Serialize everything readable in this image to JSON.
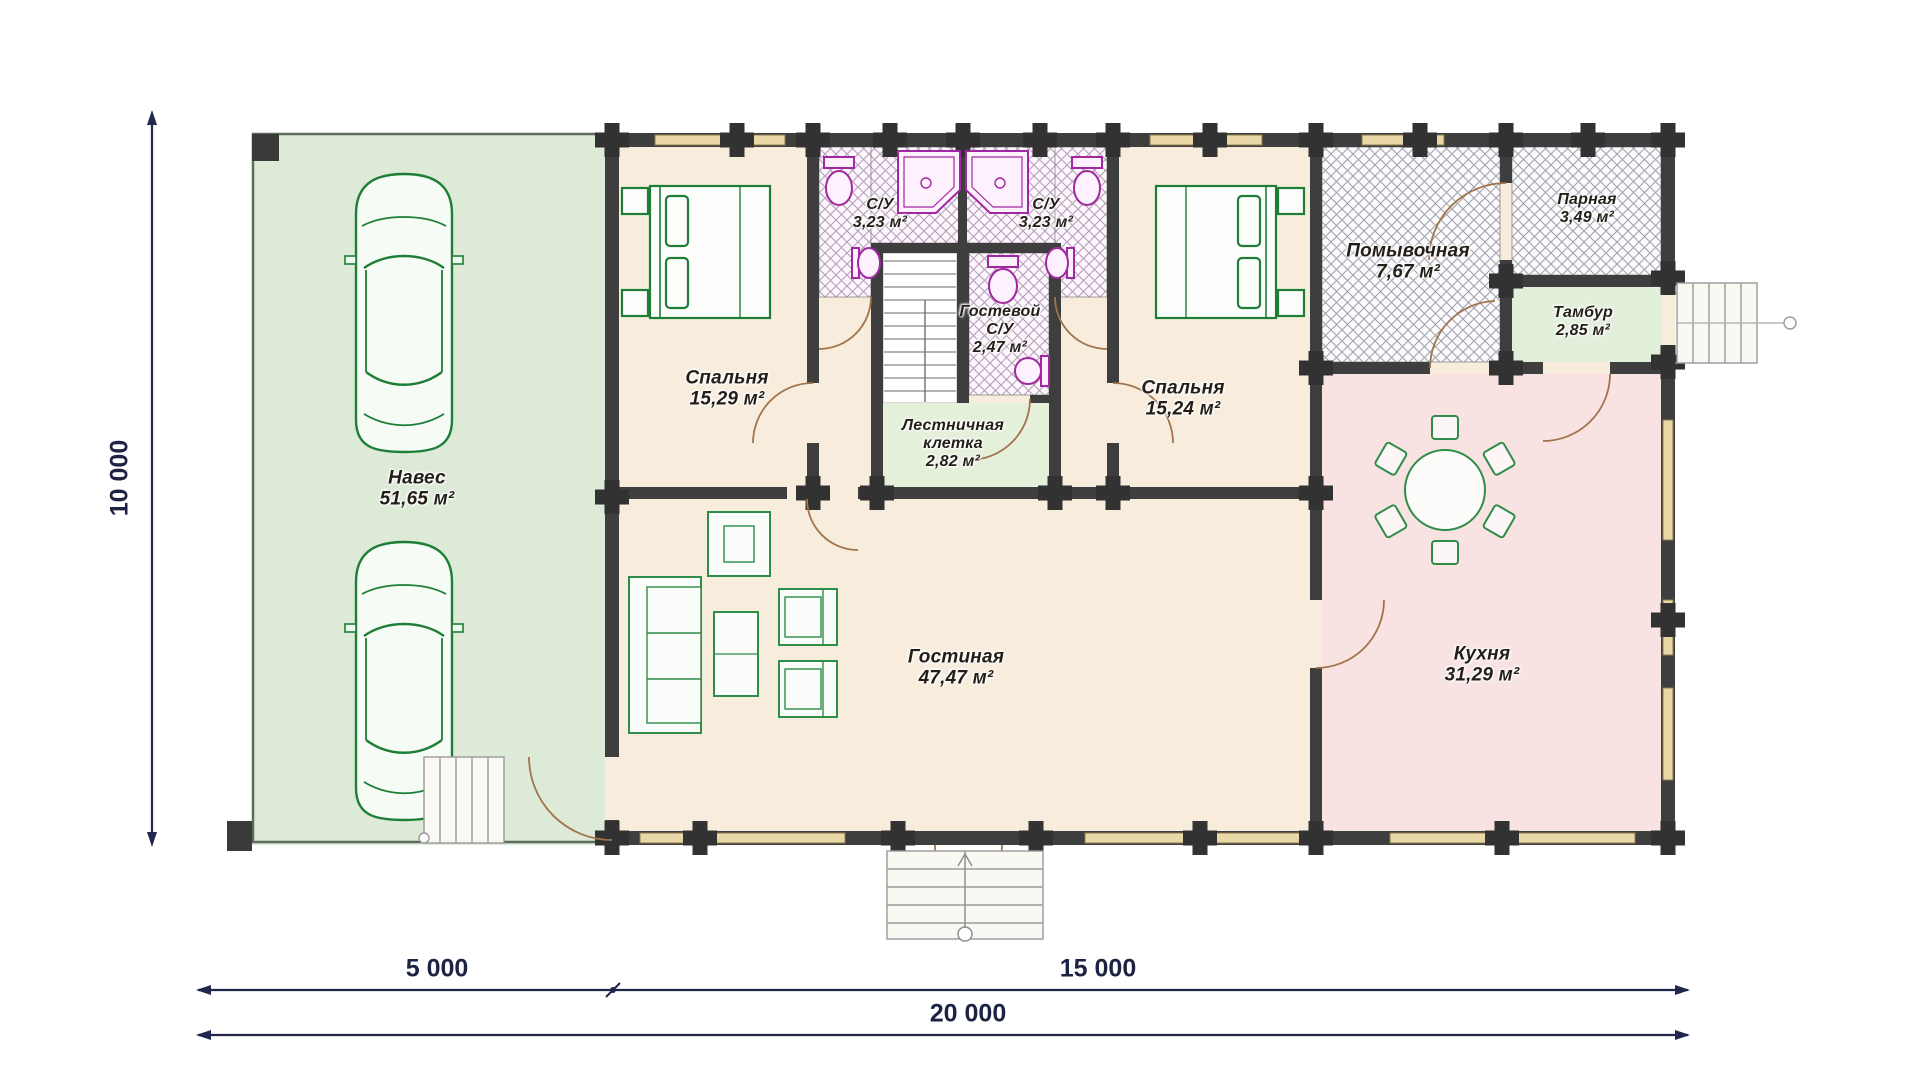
{
  "title": "План первого этажа",
  "rooms": {
    "naves": {
      "name": "Навес",
      "area": "51,65 м²"
    },
    "bedroom1": {
      "name": "Спальня",
      "area": "15,29 м²"
    },
    "su1": {
      "name": "С/У",
      "area": "3,23 м²"
    },
    "su2": {
      "name": "С/У",
      "area": "3,23 м²"
    },
    "guest_su": {
      "name": "Гостевой",
      "name2": "С/У",
      "area": "2,47 м²"
    },
    "stairwell": {
      "name": "Лестничная",
      "name2": "клетка",
      "area": "2,82 м²"
    },
    "bedroom2": {
      "name": "Спальня",
      "area": "15,24 м²"
    },
    "washroom": {
      "name": "Помывочная",
      "area": "7,67 м²"
    },
    "parnaya": {
      "name": "Парная",
      "area": "3,49 м²"
    },
    "tambur": {
      "name": "Тамбур",
      "area": "2,85 м²"
    },
    "kitchen": {
      "name": "Кухня",
      "area": "31,29 м²"
    },
    "living": {
      "name": "Гостиная",
      "area": "47,47 м²"
    }
  },
  "dimensions": {
    "height": "10 000",
    "segment1": "5 000",
    "segment2": "15 000",
    "total": "20 000"
  },
  "colors": {
    "wall": "#3e3e3e",
    "carport_green": "#dcead7",
    "room_beige": "#f8eddd",
    "kitchen_pink": "#f8e2e2",
    "vestibule_green": "#e2efdb",
    "window_tan": "#ead7a8",
    "furniture_green": "#1e7e38",
    "fixture_purple": "#a128a0",
    "dimension_navy": "#1d2342"
  }
}
